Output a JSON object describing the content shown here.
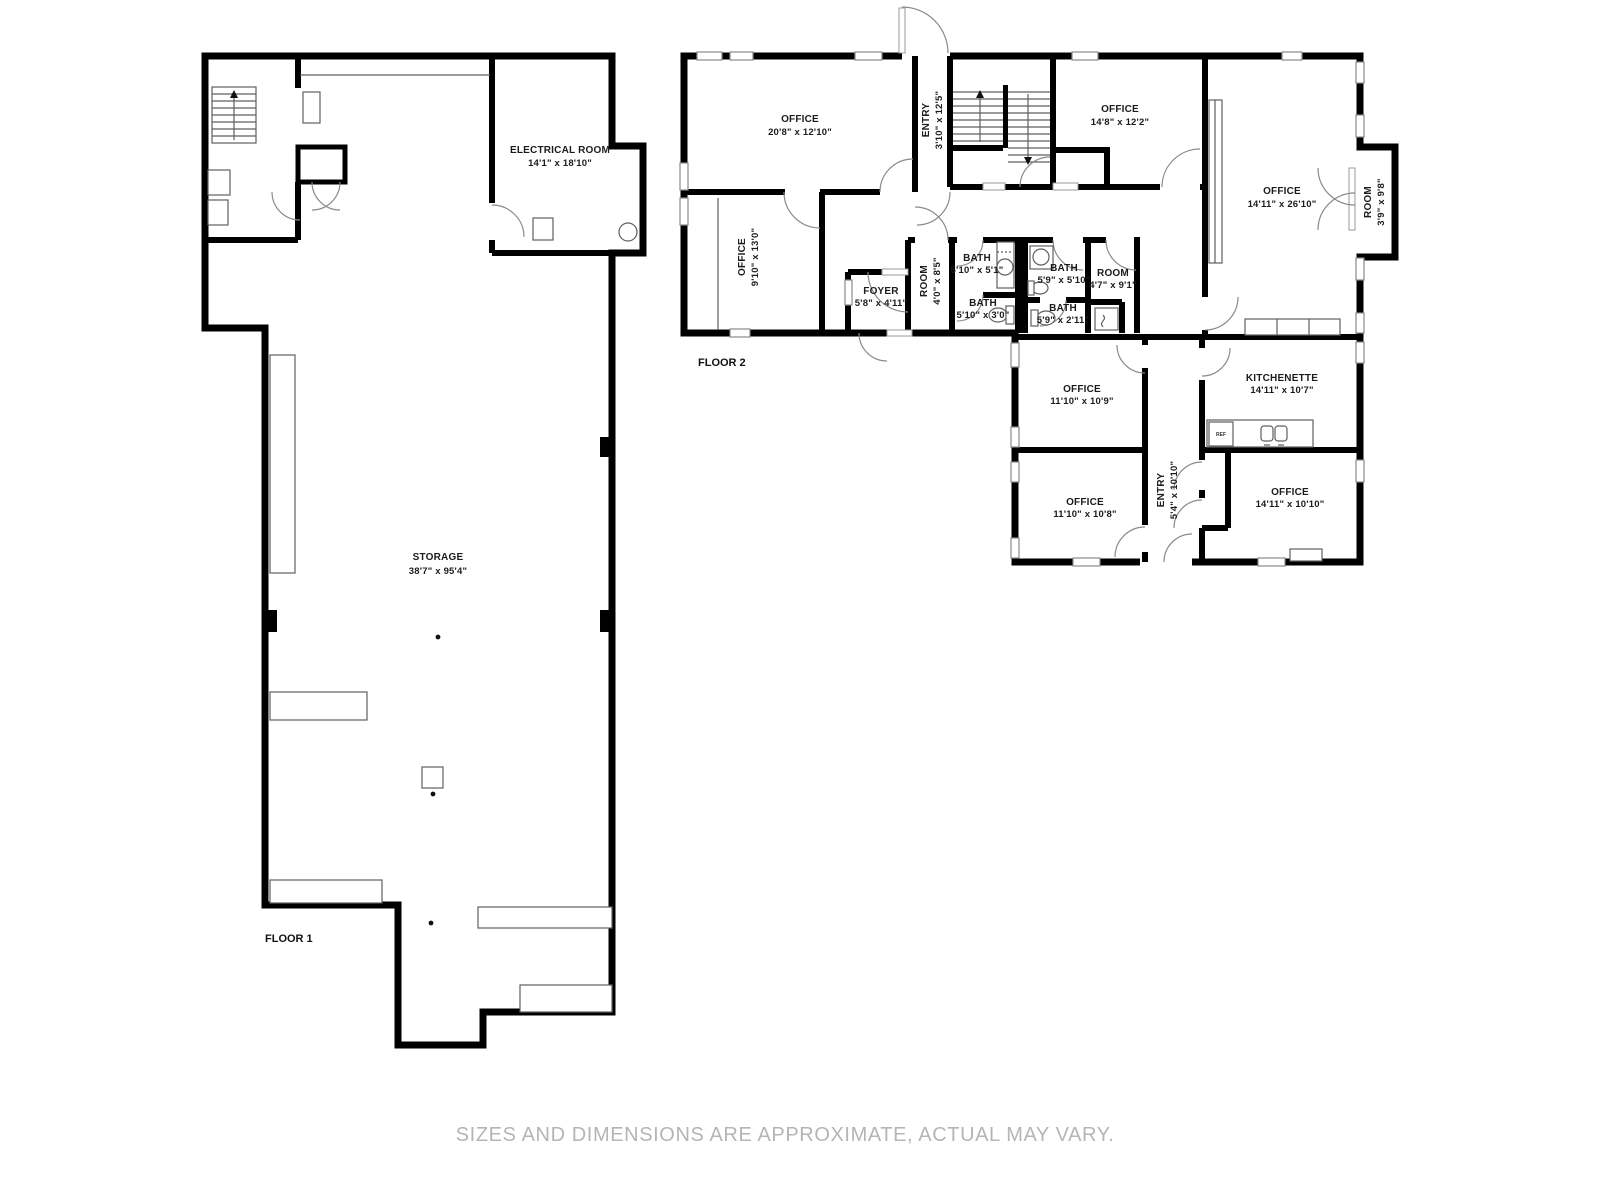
{
  "footer": {
    "disclaimer": "SIZES AND DIMENSIONS ARE APPROXIMATE, ACTUAL MAY VARY."
  },
  "floor1": {
    "label": "FLOOR 1",
    "rooms": {
      "electrical": {
        "name": "ELECTRICAL ROOM",
        "dims": "14'1\" x 18'10\""
      },
      "storage": {
        "name": "STORAGE",
        "dims": "38'7\" x 95'4\""
      }
    }
  },
  "floor2": {
    "label": "FLOOR 2",
    "rooms": {
      "office_tl": {
        "name": "OFFICE",
        "dims": "20'8\" x 12'10\""
      },
      "entry_top": {
        "name": "ENTRY",
        "dims": "3'10\" x 12'5\""
      },
      "office_tm": {
        "name": "OFFICE",
        "dims": "14'8\" x 12'2\""
      },
      "office_left": {
        "name": "OFFICE",
        "dims": "9'10\" x 13'0\""
      },
      "foyer": {
        "name": "FOYER",
        "dims": "5'8\" x 4'11\""
      },
      "room_small": {
        "name": "ROOM",
        "dims": "4'0\" x 8'5\""
      },
      "bath_a": {
        "name": "BATH",
        "dims": "5'10\" x 5'1\""
      },
      "bath_b": {
        "name": "BATH",
        "dims": "5'10\" x 3'0\""
      },
      "bath_c": {
        "name": "BATH",
        "dims": "5'9\" x 5'10\""
      },
      "bath_d": {
        "name": "BATH",
        "dims": "5'9\" x 2'11\""
      },
      "room_mid": {
        "name": "ROOM",
        "dims": "4'7\" x 9'1\""
      },
      "office_big": {
        "name": "OFFICE",
        "dims": "14'11\" x 26'10\""
      },
      "room_right": {
        "name": "ROOM",
        "dims": "3'9\" x 9'8\""
      },
      "kitchenette": {
        "name": "KITCHENETTE",
        "dims": "14'11\" x 10'7\""
      },
      "office_b1": {
        "name": "OFFICE",
        "dims": "11'10\" x 10'9\""
      },
      "office_b2": {
        "name": "OFFICE",
        "dims": "11'10\" x 10'8\""
      },
      "entry_bottom": {
        "name": "ENTRY",
        "dims": "5'4\" x 10'10\""
      },
      "office_b3": {
        "name": "OFFICE",
        "dims": "14'11\" x 10'10\""
      },
      "fridge": {
        "label": "REF"
      }
    }
  },
  "colors": {
    "wall": "#000000",
    "fixture_line": "#5f5f5f",
    "door_arc": "#8a8a8a",
    "label_text": "#1c1c1c",
    "footer_text": "#b5b5b5",
    "background": "#ffffff"
  }
}
